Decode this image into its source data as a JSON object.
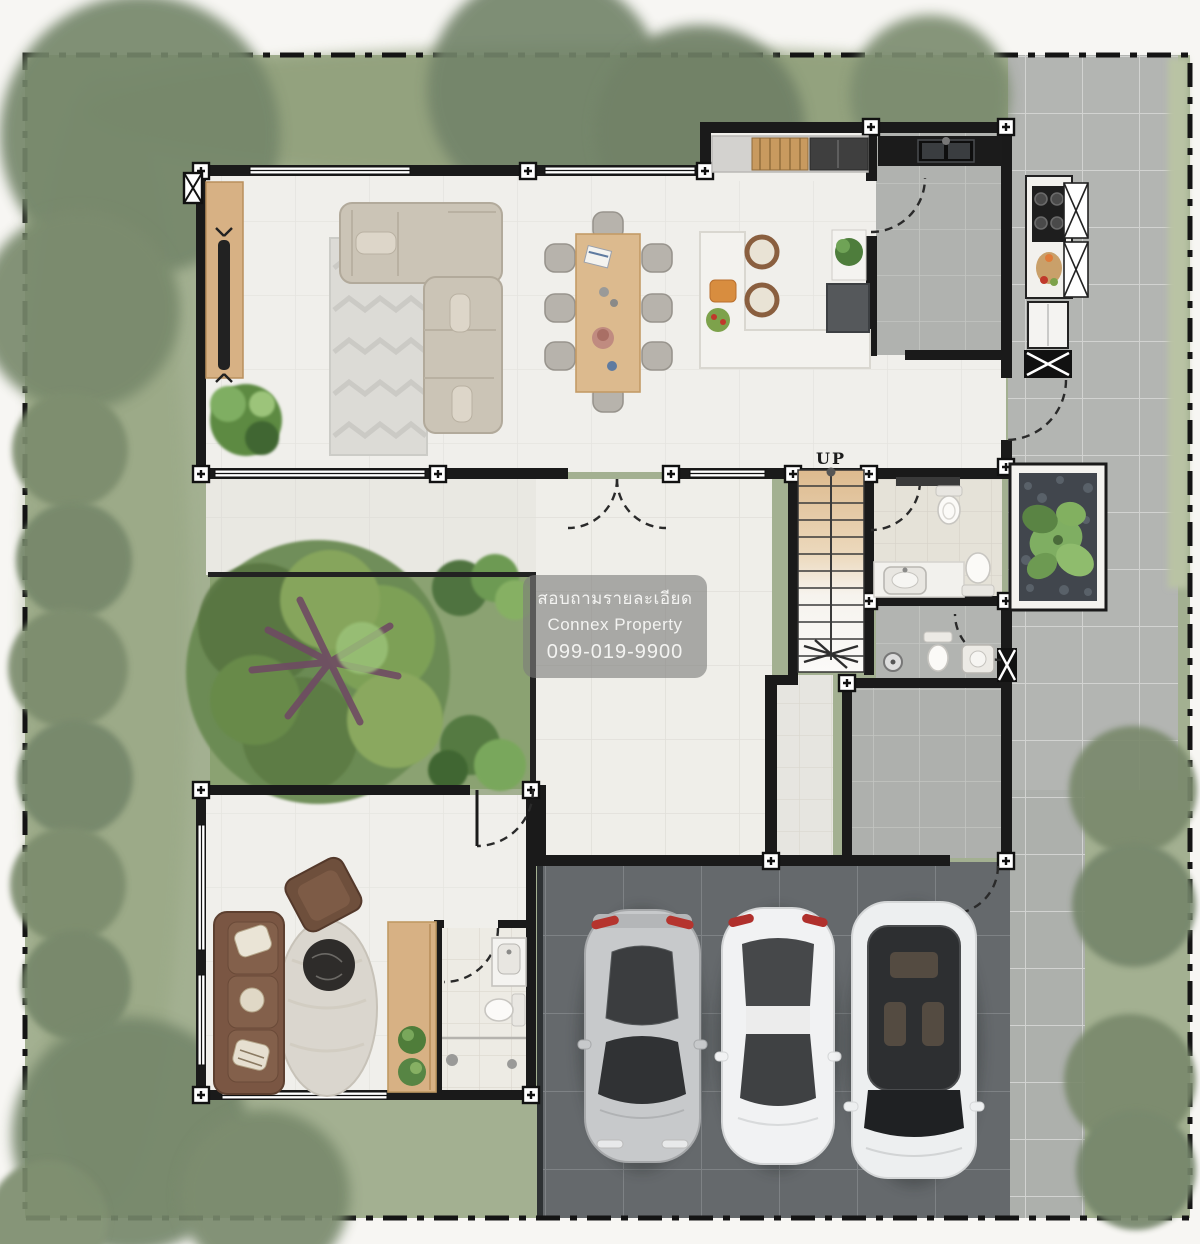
{
  "watermark": {
    "line1": "สอบถามรายละเอียด",
    "line2": "Connex Property",
    "line3": "099-019-9900"
  },
  "labels": {
    "stair_direction": "UP"
  },
  "colors": {
    "lawn": "#a3b091",
    "lawn_dark": "#87976f",
    "tree_muted": "#75866a",
    "bush": "#7b8c6d",
    "courtyard_grass": "#8ba272",
    "tree_canopy": "#6a8a52",
    "tree_branches": "#6f4b63",
    "marble_floor": "#f0efeb",
    "tile_line": "#dcdbd5",
    "terrace": "#e9e8e2",
    "patio_tile": "#b3b5b2",
    "bath_tile": "#e5e2d8",
    "gray_room": "#afb1ae",
    "carport": "#65696c",
    "wall": "#1a1a1a",
    "wood": "#d7b184",
    "stair_wood": "#ddba8e",
    "sofa_beige": "#cbc4b6",
    "sofa_brown": "#785441",
    "rug": "#dcdbd6",
    "counter_black": "#1f1f1f",
    "island_white": "#f3f2ee",
    "car_silver": "#c7c9cb",
    "car_white": "#f1f2f3",
    "glass_dark": "#3a3c3e",
    "tail_red": "#b0302c",
    "watermark_bg": "rgba(125,125,122,0.62)",
    "watermark_text": "#f3f3f1"
  },
  "legend": {
    "objects": [
      "l-shaped-sofa",
      "chevron-rug",
      "tv-console",
      "dining-table-8-chairs",
      "breakfast-island",
      "bar-stools",
      "pantry-shelves",
      "refrigerator",
      "sink-counter",
      "gas-stove",
      "stairs-up",
      "toilet",
      "vanity-sink",
      "shower-head",
      "planter-bed",
      "courtyard-tree",
      "brown-sofa",
      "armchair",
      "round-marble-table",
      "sports-car",
      "sedan-car",
      "suv-car",
      "boundary-fence",
      "lawn-bushes"
    ]
  }
}
